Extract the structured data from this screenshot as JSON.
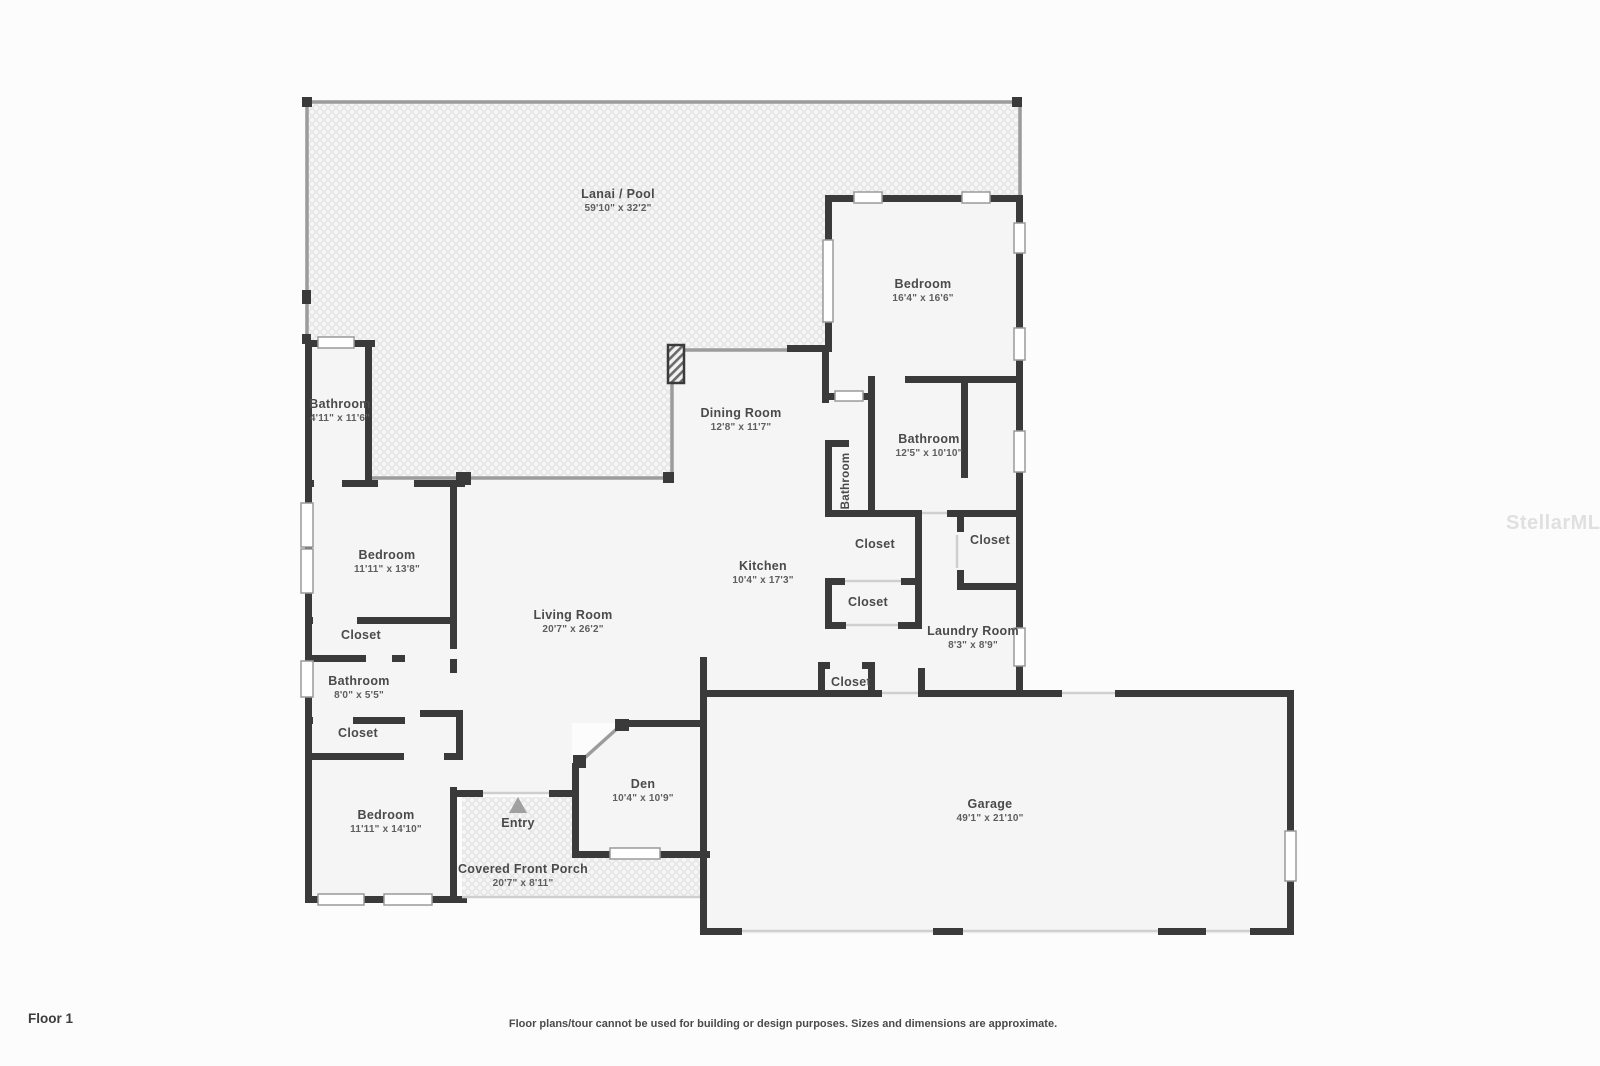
{
  "floor": {
    "label": "Floor 1"
  },
  "footer": {
    "disclaimer": "Floor plans/tour cannot be used for building or design purposes. Sizes and dimensions are approximate."
  },
  "watermark": {
    "text": "StellarMLS"
  },
  "colors": {
    "wall": "#3a3a3a",
    "room_fill": "#f5f5f5",
    "screen_line": "#9c9c9c",
    "background": "#fcfcfc",
    "label_text": "#4a4a4a"
  },
  "rooms": {
    "lanai": {
      "name": "Lanai / Pool",
      "dims": "59'10\" x 32'2\""
    },
    "bedroom_right": {
      "name": "Bedroom",
      "dims": "16'4\" x 16'6\""
    },
    "bathroom_pool": {
      "name": "Bathroom",
      "dims": "4'11\" x 11'6\""
    },
    "dining_room": {
      "name": "Dining Room",
      "dims": "12'8\" x 11'7\""
    },
    "bathroom_hall": {
      "name": "Bathroom"
    },
    "bathroom_right": {
      "name": "Bathroom",
      "dims": "12'5\" x 10'10\""
    },
    "bedroom_mid": {
      "name": "Bedroom",
      "dims": "11'11\" x 13'8\""
    },
    "kitchen": {
      "name": "Kitchen",
      "dims": "10'4\" x 17'3\""
    },
    "living_room": {
      "name": "Living Room",
      "dims": "20'7\" x 26'2\""
    },
    "bathroom_mid": {
      "name": "Bathroom",
      "dims": "8'0\" x 5'5\""
    },
    "laundry_room": {
      "name": "Laundry Room",
      "dims": "8'3\" x 8'9\""
    },
    "bedroom_front": {
      "name": "Bedroom",
      "dims": "11'11\" x 14'10\""
    },
    "entry": {
      "name": "Entry"
    },
    "den": {
      "name": "Den",
      "dims": "10'4\" x 10'9\""
    },
    "porch": {
      "name": "Covered Front Porch",
      "dims": "20'7\" x 8'11\""
    },
    "garage": {
      "name": "Garage",
      "dims": "49'1\" x 21'10\""
    },
    "closets": [
      {
        "name": "Closet"
      },
      {
        "name": "Closet"
      },
      {
        "name": "Closet"
      },
      {
        "name": "Closet"
      },
      {
        "name": "Closet"
      },
      {
        "name": "Closet"
      }
    ]
  }
}
